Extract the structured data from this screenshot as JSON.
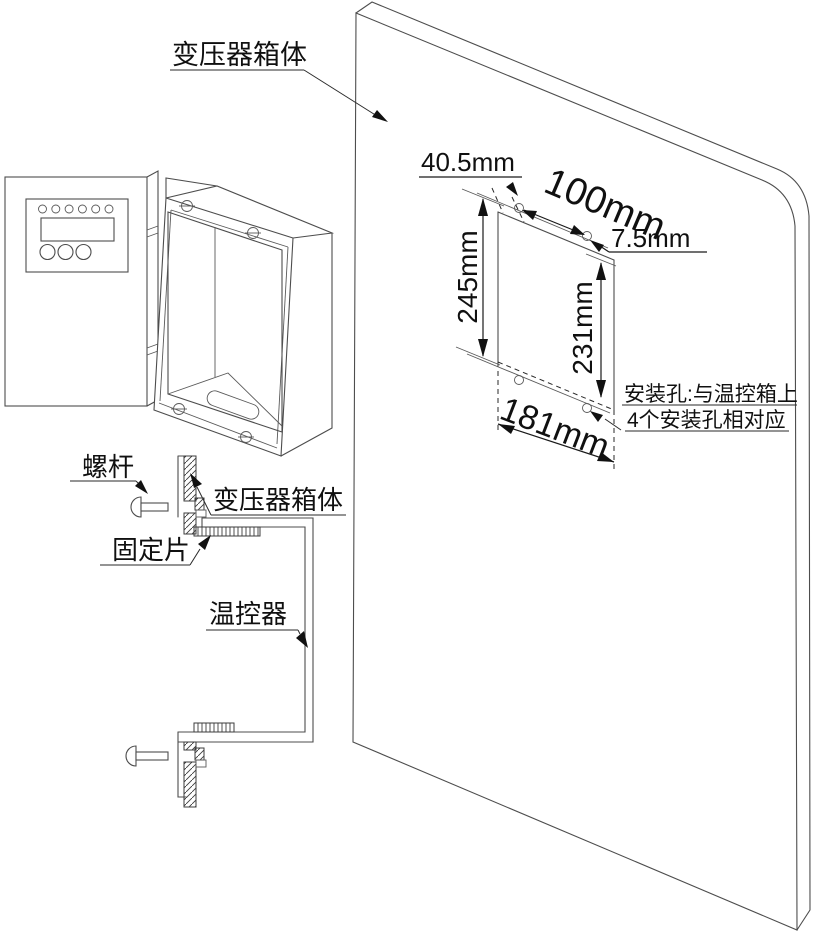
{
  "labels": {
    "transformer_box_top": "变压器箱体",
    "screw": "螺杆",
    "transformer_box_section": "变压器箱体",
    "fixing_piece": "固定片",
    "thermostat": "温控器"
  },
  "dimensions": {
    "hole_edge_offset": "40.5mm",
    "hole_spacing_horizontal": "100mm",
    "hole_corner_offset": "7.5mm",
    "cutout_height": "245mm",
    "hole_spacing_vertical": "231mm",
    "cutout_width": "181mm"
  },
  "note": {
    "line1": "安装孔:与温控箱上",
    "line2": "4个安装孔相对应"
  },
  "colors": {
    "outline": "#4d4d4d",
    "dimension": "#1a1a1a",
    "background": "#ffffff"
  }
}
